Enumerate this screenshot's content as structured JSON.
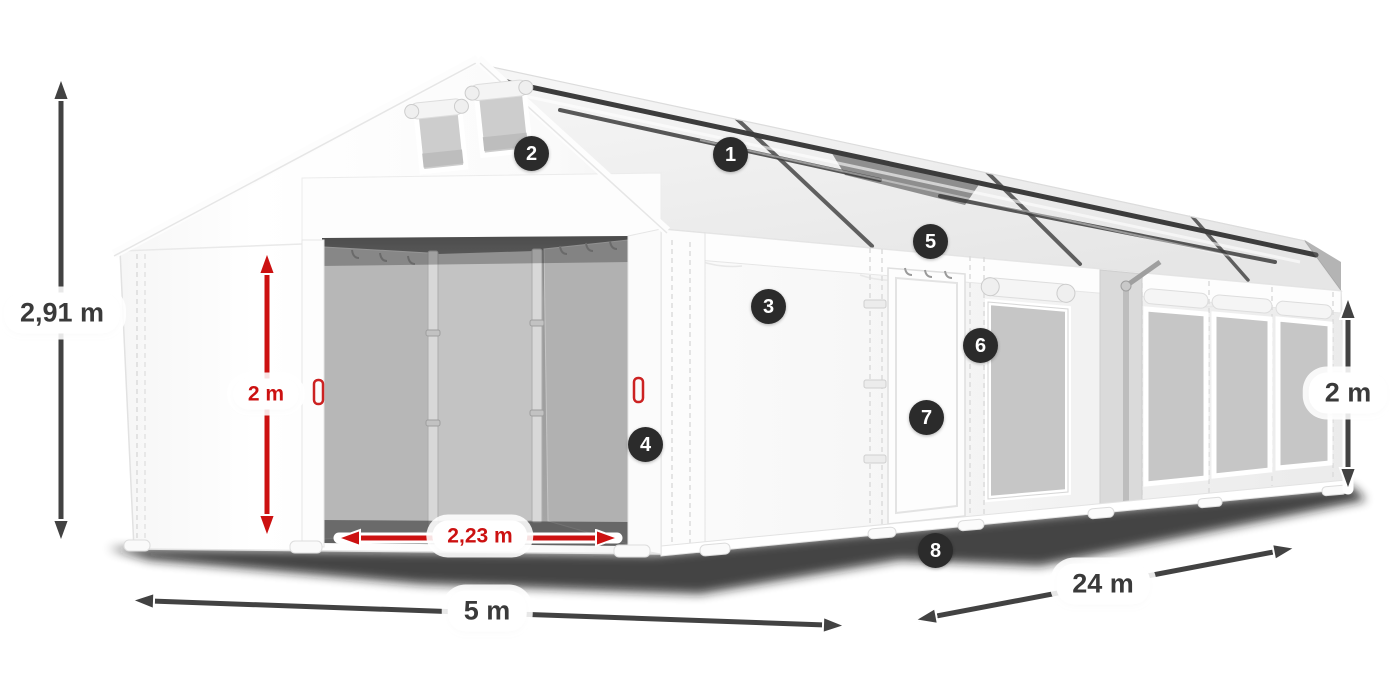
{
  "illustration": {
    "subject": "White marquee tent with front entrance, gable vents, side door, mesh windows and visible roof frame"
  },
  "dimensions": {
    "total_height": "2,91 m",
    "clear_height": "2 m",
    "entrance_width": "2,23 m",
    "width": "5 m",
    "length": "24 m",
    "side_height": "2 m"
  },
  "markers": [
    "1",
    "2",
    "3",
    "4",
    "5",
    "6",
    "7",
    "8"
  ],
  "colors": {
    "dimension_dark": "#424242",
    "dimension_red": "#cc1111",
    "badge_background": "#2b2b2b",
    "badge_text": "#ffffff",
    "label_background": "#ffffff",
    "label_text_dark": "#3a3a3a"
  }
}
